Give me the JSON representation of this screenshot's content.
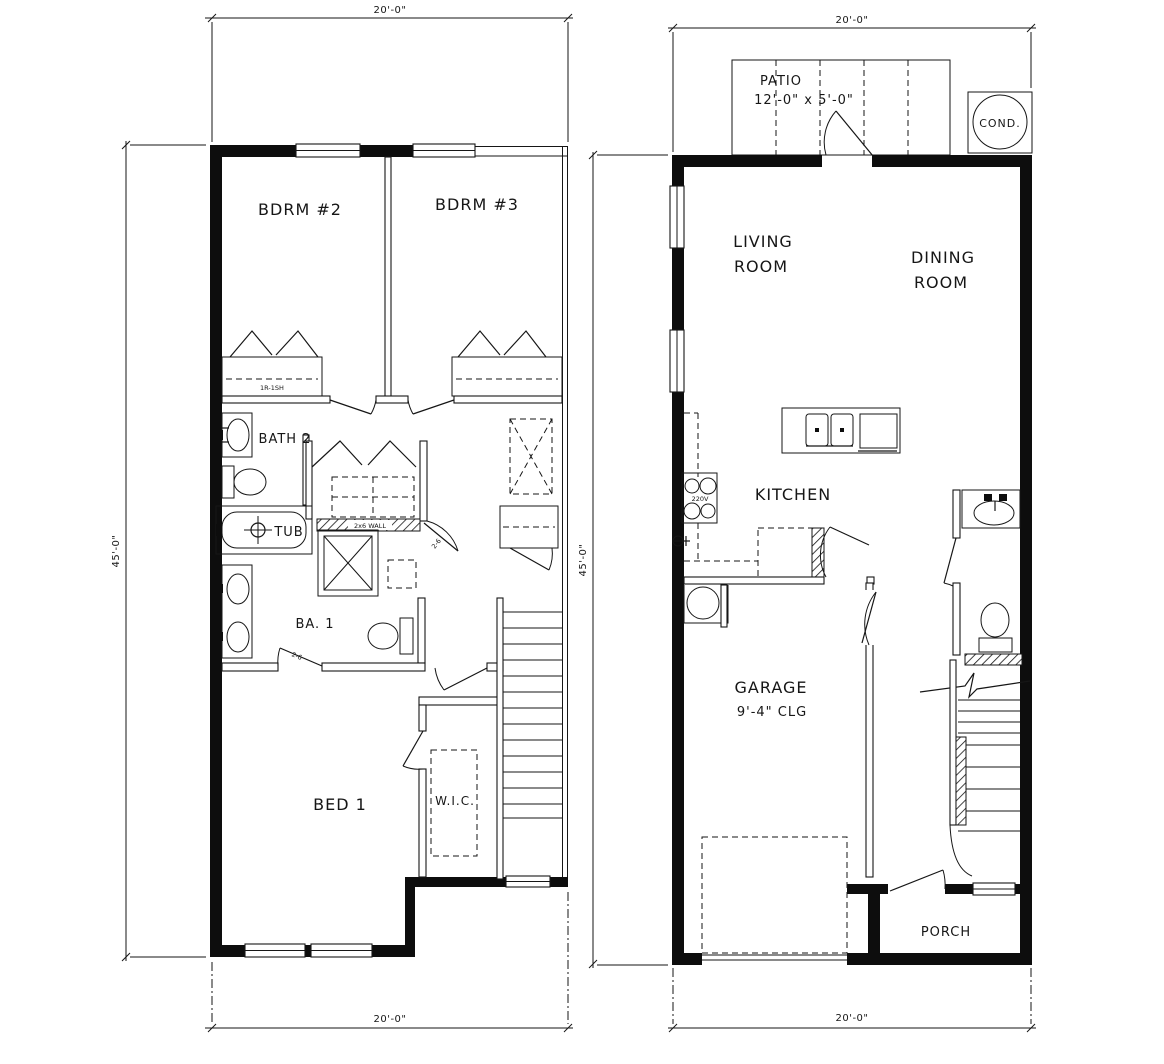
{
  "colors": {
    "background": "#ffffff",
    "line": "#161616",
    "text": "#161616"
  },
  "floor2": {
    "dim_top": "20'-0\"",
    "dim_left": "45'-0\"",
    "dim_bottom": "20'-0\"",
    "labels": {
      "bdrm2": "BDRM #2",
      "bdrm3": "BDRM #3",
      "closet_note": "1R-1SH",
      "bath2": "BATH 2",
      "tub": "TUB",
      "wall_note": "2x6 WALL",
      "ba1": "BA. 1",
      "door_hall": "2-6",
      "door_ba1": "2-6",
      "bed1": "BED 1",
      "wic": "W.I.C."
    }
  },
  "floor1": {
    "dim_top": "20'-0\"",
    "dim_left": "45'-0\"",
    "dim_bottom": "20'-0\"",
    "labels": {
      "patio": "PATIO",
      "patio_size": "12'-0\" x 5'-0\"",
      "cond": "COND.",
      "living1": "LIVING",
      "living2": "ROOM",
      "dining1": "DINING",
      "dining2": "ROOM",
      "kitchen": "KITCHEN",
      "range_note": "220V",
      "garage1": "GARAGE",
      "garage2": "9'-4\" CLG",
      "porch": "PORCH"
    }
  }
}
